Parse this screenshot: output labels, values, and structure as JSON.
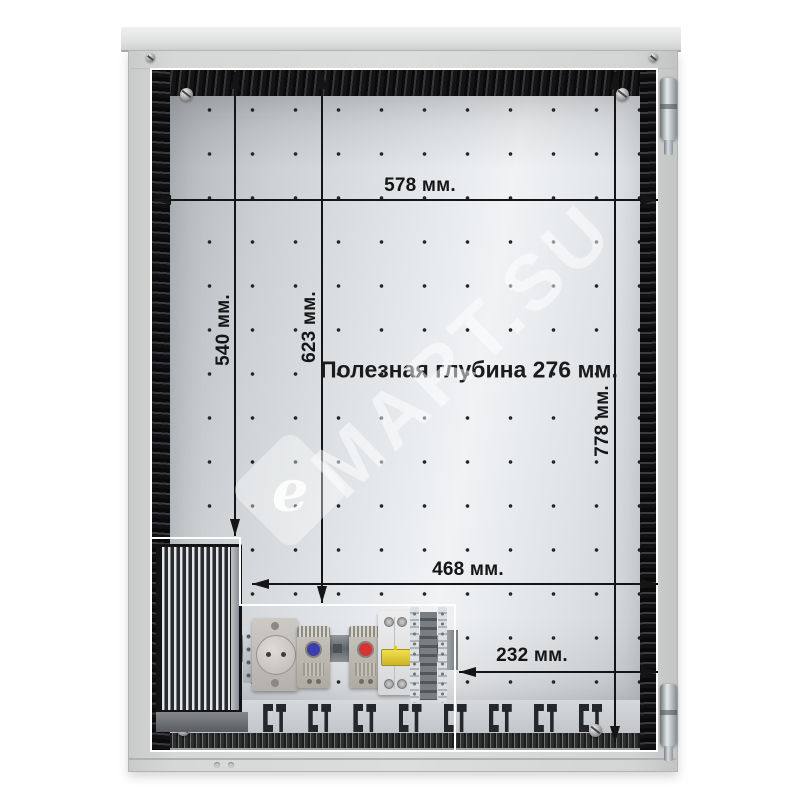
{
  "watermark": {
    "logo_letter": "e",
    "text": "MART.SU"
  },
  "annotations": {
    "width_top": "578 мм.",
    "height_left": "540 мм.",
    "height_center": "623 мм.",
    "height_right": "778 мм.",
    "width_center": "468 мм.",
    "width_bottom": "232 мм.",
    "useful_depth": "Полезная глубина 276 мм."
  },
  "components": {
    "heatsink": "heatsink-heater",
    "socket": "din-socket-outlet",
    "thermostat_cooling": "thermostat-blue-dial",
    "thermostat_heating": "thermostat-red-dial",
    "breaker": "circuit-breaker-2p",
    "terminals": "terminal-blocks",
    "hinges": "door-hinges"
  },
  "colors": {
    "dimension_ink": "#151515",
    "outline_white": "#ffffff",
    "cabinet_gray": "#d3d5d4",
    "breaker_handle_yellow": "#e5d238",
    "thermostat_dial_blue": "#3b3fae",
    "thermostat_dial_red": "#d93434"
  }
}
